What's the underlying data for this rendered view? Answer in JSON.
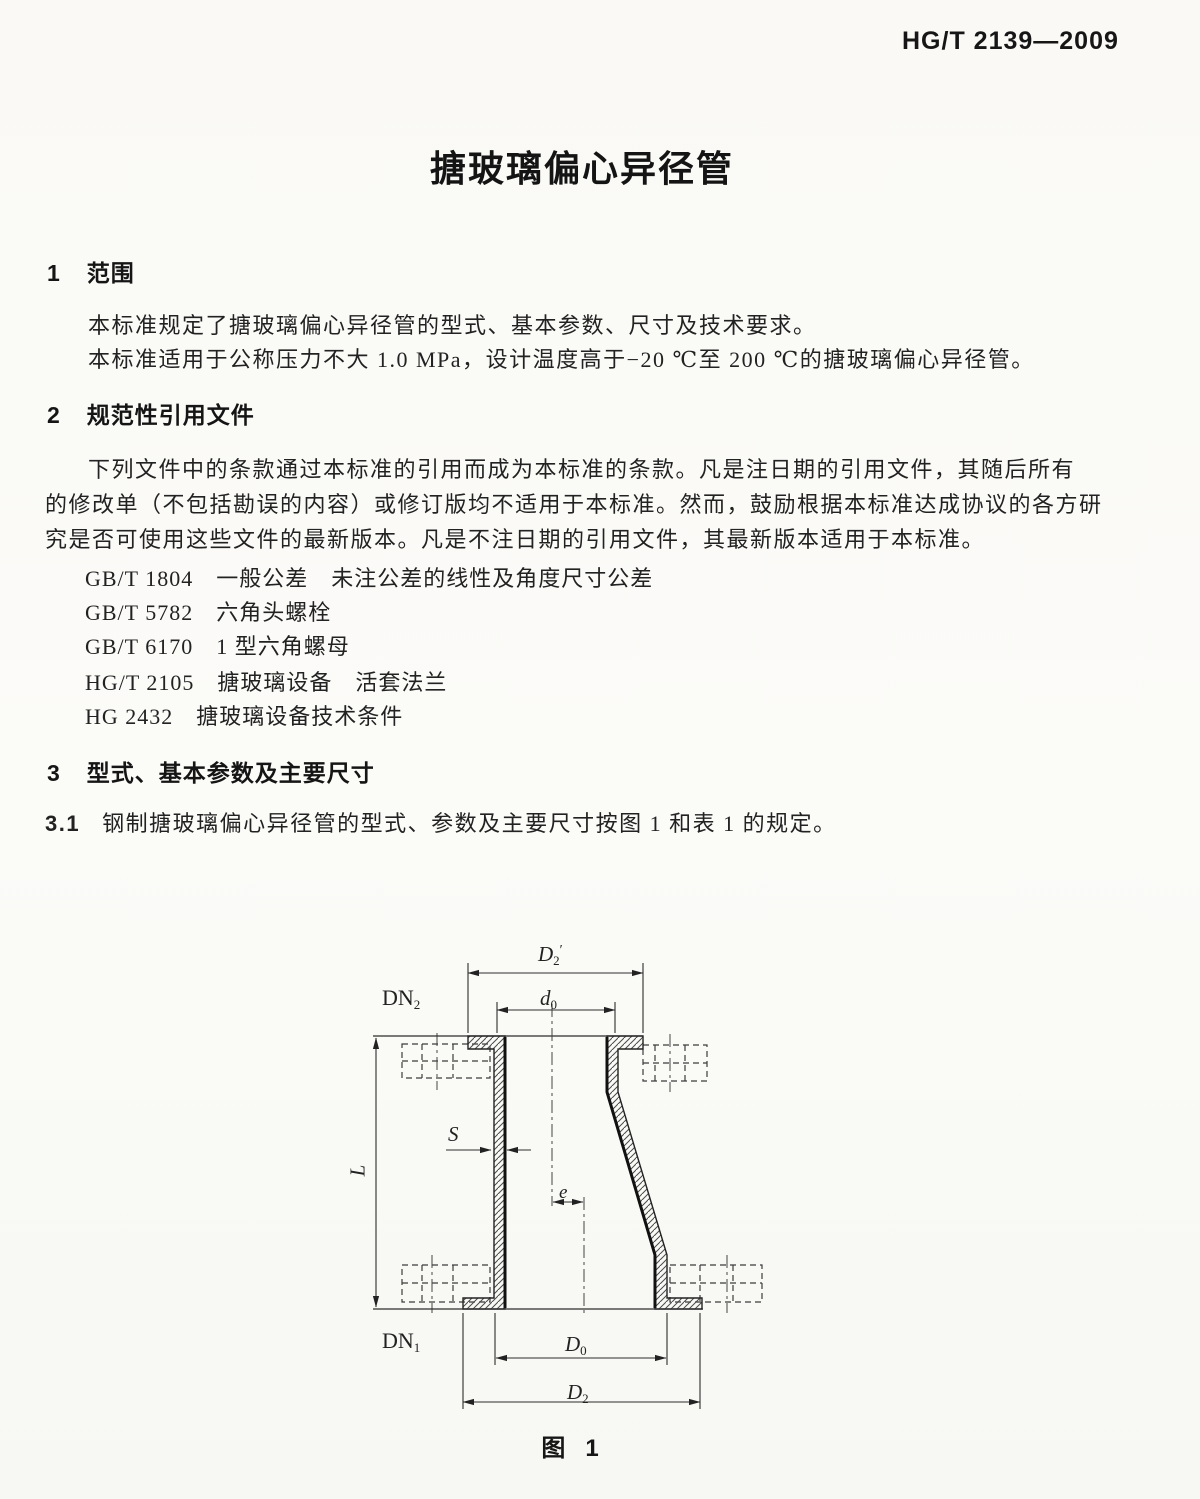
{
  "colors": {
    "paper": "#fbfaf7",
    "ink": "#1f1f1f",
    "line": "#2d2d2d"
  },
  "header": {
    "standard_code": "HG/T 2139—2009"
  },
  "title": "搪玻璃偏心异径管",
  "sec1": {
    "num": "1",
    "heading": "范围",
    "lines": [
      "本标准规定了搪玻璃偏心异径管的型式、基本参数、尺寸及技术要求。",
      "本标准适用于公称压力不大 1.0 MPa，设计温度高于−20 ℃至 200 ℃的搪玻璃偏心异径管。"
    ]
  },
  "sec2": {
    "num": "2",
    "heading": "规范性引用文件",
    "lines": [
      "下列文件中的条款通过本标准的引用而成为本标准的条款。凡是注日期的引用文件，其随后所有",
      "的修改单（不包括勘误的内容）或修订版均不适用于本标准。然而，鼓励根据本标准达成协议的各方研",
      "究是否可使用这些文件的最新版本。凡是不注日期的引用文件，其最新版本适用于本标准。"
    ]
  },
  "refs": [
    "GB/T 1804　一般公差　未注公差的线性及角度尺寸公差",
    "GB/T 5782　六角头螺栓",
    "GB/T 6170　1 型六角螺母",
    "HG/T 2105　搪玻璃设备　活套法兰",
    "HG 2432　搪玻璃设备技术条件"
  ],
  "sec3": {
    "num": "3",
    "heading": "型式、基本参数及主要尺寸"
  },
  "clause31": {
    "num": "3.1",
    "text": "钢制搪玻璃偏心异径管的型式、参数及主要尺寸按图 1 和表 1 的规定。"
  },
  "figure": {
    "labels": {
      "d2_top": {
        "base": "D",
        "sub": "2",
        "prime": "′"
      },
      "d0_top": {
        "base": "d",
        "sub": "0"
      },
      "dn2": {
        "base": "DN",
        "sub": "2"
      },
      "L": {
        "base": "L"
      },
      "S": {
        "base": "S"
      },
      "e": {
        "base": "e"
      },
      "dn1": {
        "base": "DN",
        "sub": "1"
      },
      "d0_bottom": {
        "base": "D",
        "sub": "0"
      },
      "d2_bottom": {
        "base": "D",
        "sub": "2"
      }
    },
    "caption": {
      "cn": "图",
      "num": "1"
    }
  }
}
